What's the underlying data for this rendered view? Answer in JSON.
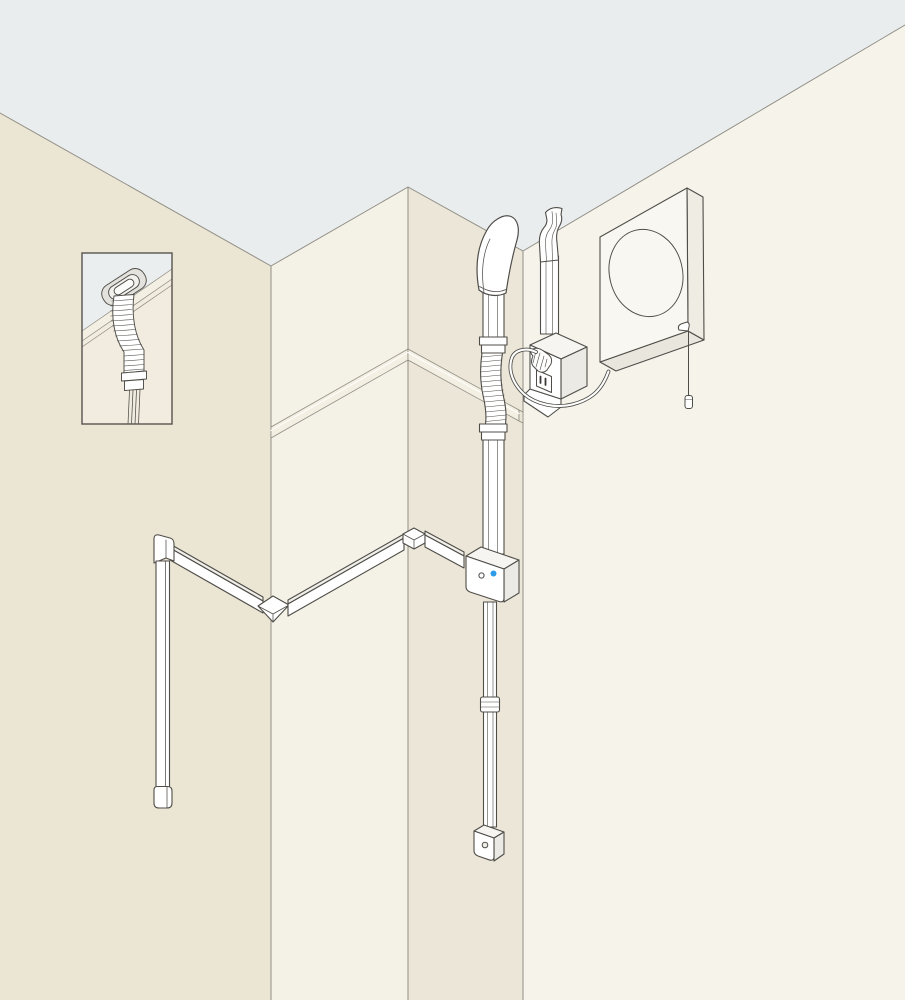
{
  "illustration": {
    "title": "Isometric room-corner installation diagram",
    "components": [
      "ceiling-plane",
      "left-wall",
      "corner-column",
      "right-wall",
      "wall-trim-rail",
      "inset-detail-box",
      "ceiling-grommet",
      "flexible-corrugated-hose",
      "hose-coupler",
      "cable-bundle",
      "trunking-top-elbow",
      "trunking-vertical-run",
      "trunking-end-cap",
      "trunking-diagonal-run",
      "trunking-corner-elbow",
      "trunking-peak-fitting",
      "ceiling-cowl",
      "upper-duct",
      "duct-coupler",
      "corrugated-duct-section",
      "junction-box",
      "junction-led",
      "junction-button",
      "drop-conduit",
      "drop-coupler",
      "sensor-box",
      "outlet-trunking-bend",
      "outlet-trunking",
      "outlet-box",
      "power-plug",
      "outlet-socket",
      "power-cord",
      "ventilation-fan-unit",
      "fan-opening",
      "pull-cord",
      "pull-cord-handle"
    ]
  },
  "palette": {
    "ceiling": "#e9edee",
    "wall_left": "#ebe5d4",
    "column_left_face": "#f4f1e6",
    "column_right_face": "#ebe6d8",
    "wall_right": "#f5f3ea",
    "inset_ceiling": "#eaeeef",
    "inset_wall": "#f1ecdf",
    "trim": "#f3efe2",
    "line": "#4f4d48",
    "seam": "#8e8b82",
    "inset_border": "#57544e",
    "fixture_white": "#ffffff",
    "fixture_shade_light": "#f6f5f2",
    "fixture_shade": "#eceae4",
    "led_blue": "#2d9ce8"
  }
}
